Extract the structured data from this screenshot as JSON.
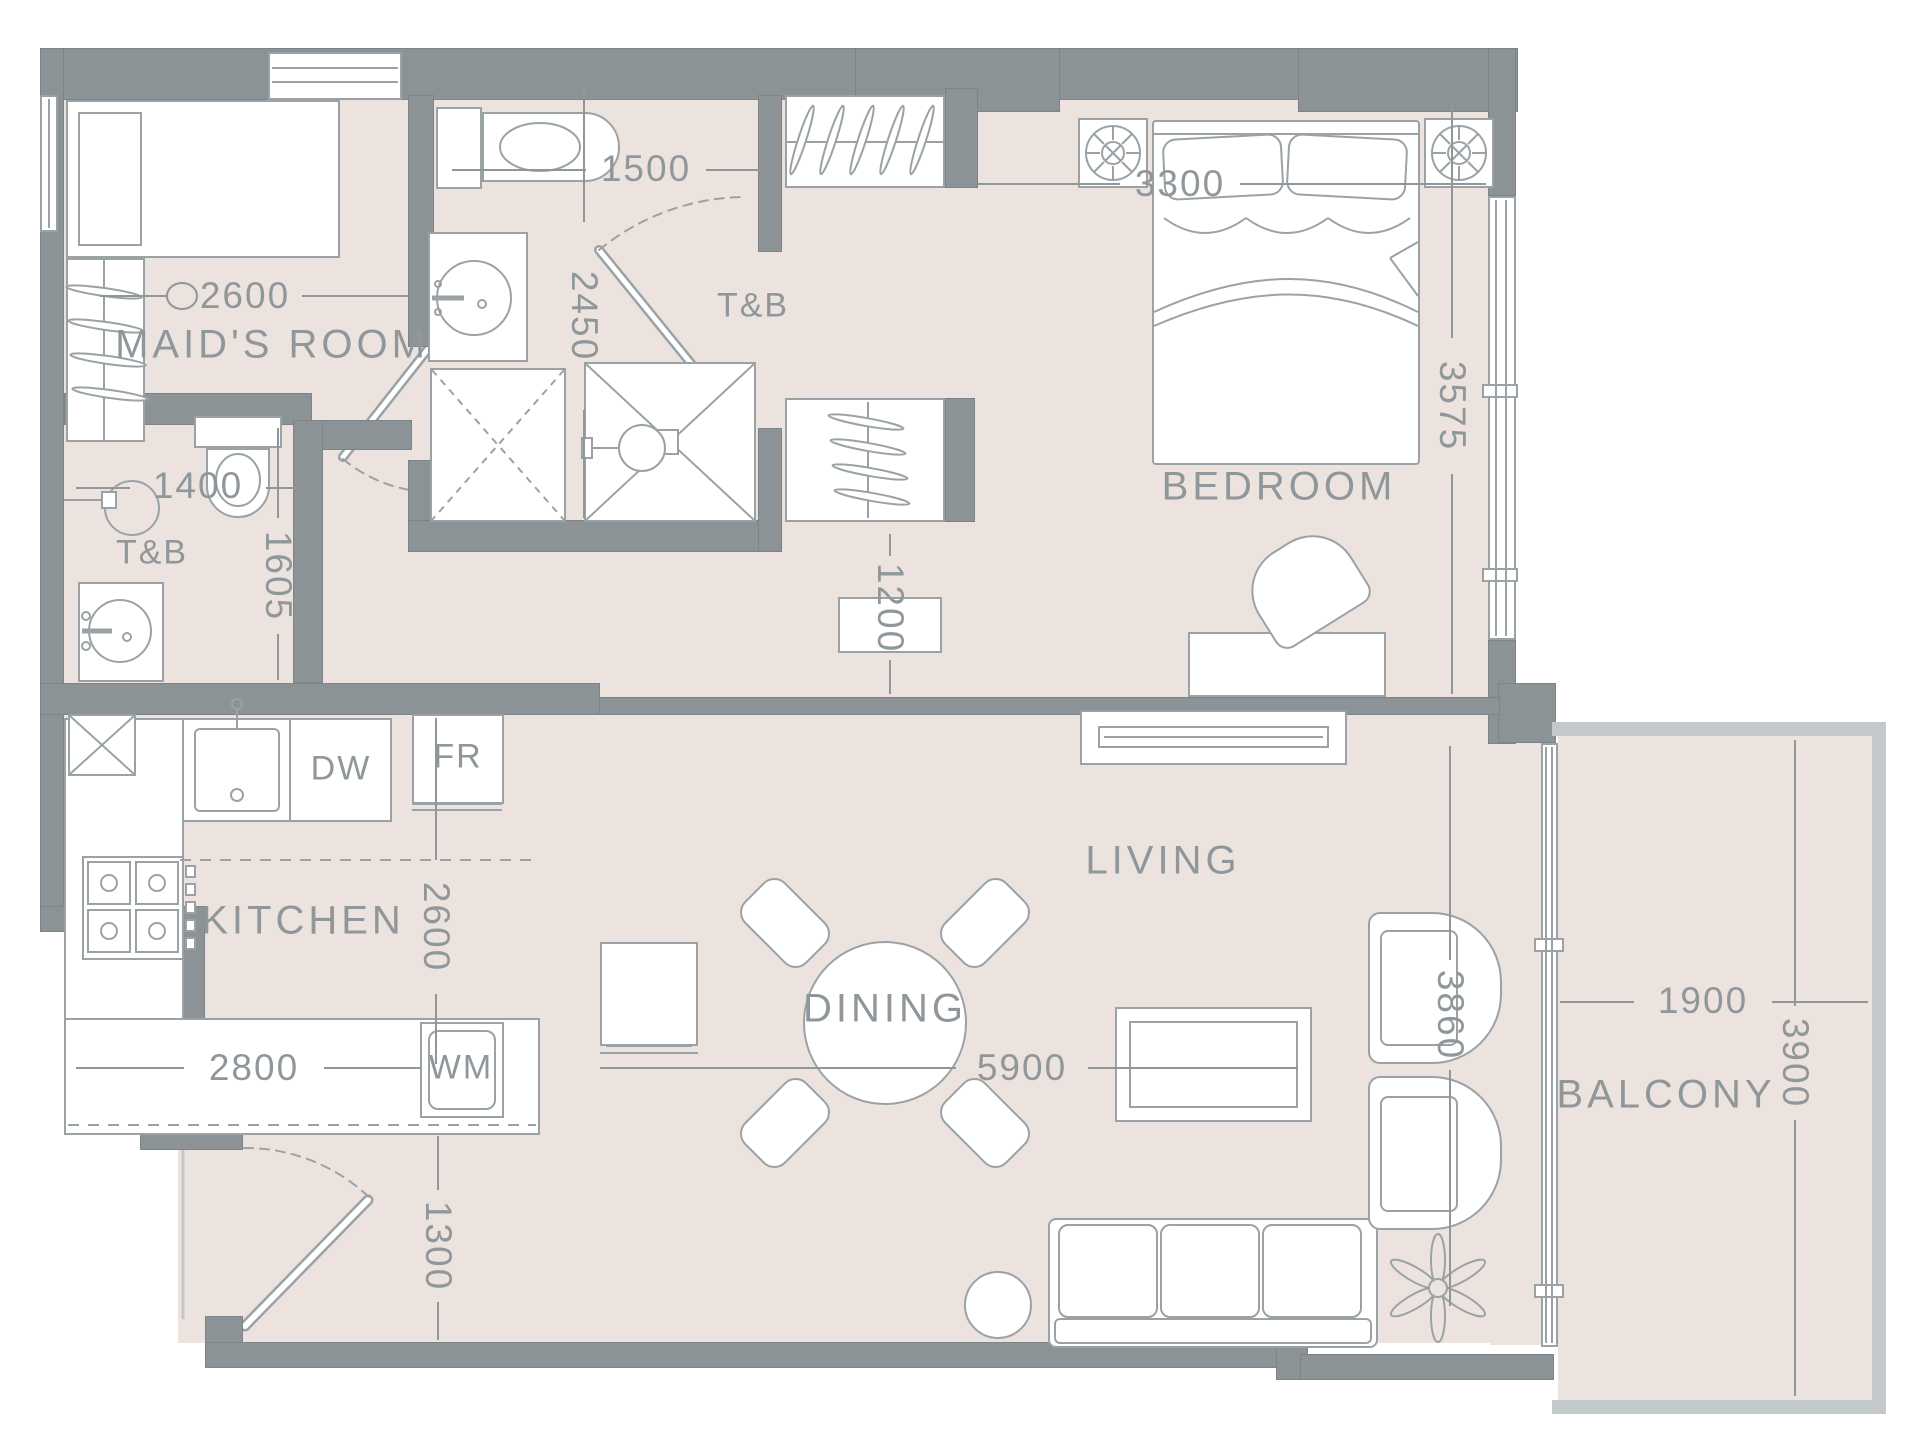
{
  "labels": {
    "maids_room": "MAID'S ROOM",
    "tb_left": "T&B",
    "tb_center": "T&B",
    "bedroom": "BEDROOM",
    "kitchen": "KITCHEN",
    "dining": "DINING",
    "living": "LIVING",
    "balcony": "BALCONY"
  },
  "appliances": {
    "dishwasher": "DW",
    "fridge": "FR",
    "washing_machine": "WM"
  },
  "dimensions": {
    "maids_room_width": "2600",
    "tb_center_width": "1500",
    "tb_center_depth": "2450",
    "tb_left_width": "1400",
    "tb_left_depth": "1605",
    "bedroom_width": "3300",
    "bedroom_depth": "3575",
    "hallway_width": "1200",
    "kitchen_depth": "2600",
    "kitchen_width": "2800",
    "entry_width": "1300",
    "living_width": "5900",
    "living_depth": "3860",
    "balcony_width": "1900",
    "balcony_depth": "3900"
  },
  "colors": {
    "wall": "#8c9396",
    "floor": "#ece3de",
    "outline": "#9aa2a5",
    "text": "#8f979a"
  }
}
